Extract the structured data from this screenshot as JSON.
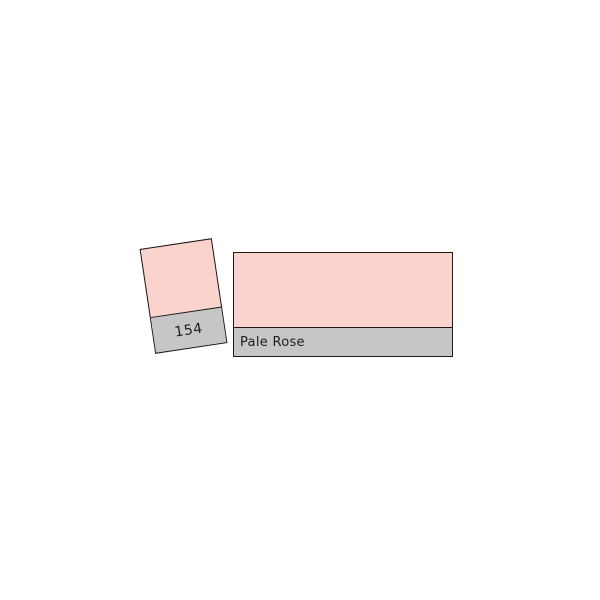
{
  "page": {
    "background": "#ffffff"
  },
  "swatch": {
    "code": "154",
    "name": "Pale Rose",
    "colors": {
      "fill": "#fbd3cd",
      "label_bg": "#c6c6c6",
      "border": "#1a1a1a",
      "text": "#1f1f1f"
    }
  }
}
